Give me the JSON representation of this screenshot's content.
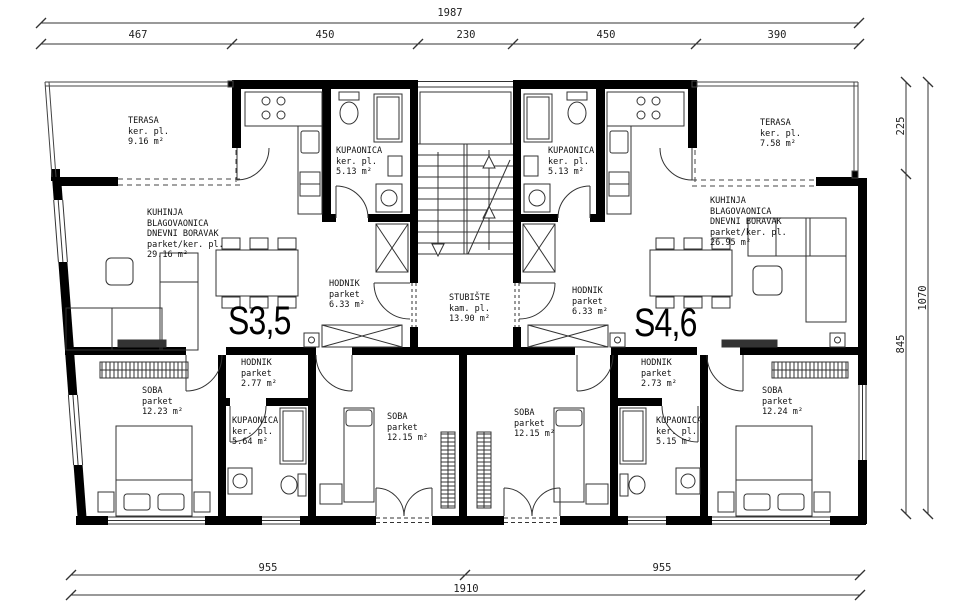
{
  "dimensions_cm": {
    "top_total": "1987",
    "top_segments": [
      "467",
      "450",
      "230",
      "450",
      "390"
    ],
    "right_segments": [
      "225",
      "845"
    ],
    "right_total": "1070",
    "bottom_segments": [
      "955",
      "955"
    ],
    "bottom_total": "1910"
  },
  "apartments": {
    "left": {
      "label": "S3,5"
    },
    "right": {
      "label": "S4,6"
    }
  },
  "rooms": {
    "terasa_left": {
      "name": "TERASA",
      "floor": "ker. pl.",
      "area": "9.16 m²"
    },
    "terasa_right": {
      "name": "TERASA",
      "floor": "ker. pl.",
      "area": "7.58 m²"
    },
    "kuhinja_left": {
      "name": "KUHINJA",
      "name2": "BLAGOVAONICA",
      "name3": "DNEVNI BORAVAK",
      "floor": "parket/ker. pl.",
      "area": "29.16 m²"
    },
    "kuhinja_right": {
      "name": "KUHINJA",
      "name2": "BLAGOVAONICA",
      "name3": "DNEVNI BORAVAK",
      "floor": "parket/ker. pl.",
      "area": "26.95 m²"
    },
    "kupaonica_top_left": {
      "name": "KUPAONICA",
      "floor": "ker. pl.",
      "area": "5.13 m²"
    },
    "kupaonica_top_right": {
      "name": "KUPAONICA",
      "floor": "ker. pl.",
      "area": "5.13 m²"
    },
    "hodnik_upper_left": {
      "name": "HODNIK",
      "floor": "parket",
      "area": "6.33 m²"
    },
    "hodnik_upper_right": {
      "name": "HODNIK",
      "floor": "parket",
      "area": "6.33 m²"
    },
    "stubiste": {
      "name": "STUBIŠTE",
      "floor": "kam. pl.",
      "area": "13.90 m²"
    },
    "hodnik_lower_left": {
      "name": "HODNIK",
      "floor": "parket",
      "area": "2.77 m²"
    },
    "hodnik_lower_right": {
      "name": "HODNIK",
      "floor": "parket",
      "area": "2.73 m²"
    },
    "soba_left": {
      "name": "SOBA",
      "floor": "parket",
      "area": "12.23 m²"
    },
    "soba_mid_left": {
      "name": "SOBA",
      "floor": "parket",
      "area": "12.15 m²"
    },
    "soba_mid_right": {
      "name": "SOBA",
      "floor": "parket",
      "area": "12.15 m²"
    },
    "soba_right": {
      "name": "SOBA",
      "floor": "parket",
      "area": "12.24 m²"
    },
    "kupaonica_lower_left": {
      "name": "KUPAONICA",
      "floor": "ker. pl.",
      "area": "5.64 m²"
    },
    "kupaonica_lower_right": {
      "name": "KUPAONICA",
      "floor": "ker. pl.",
      "area": "5.15 m²"
    }
  },
  "colors": {
    "walls": "#000000",
    "lines": "#2b2b2b",
    "background": "#ffffff"
  }
}
